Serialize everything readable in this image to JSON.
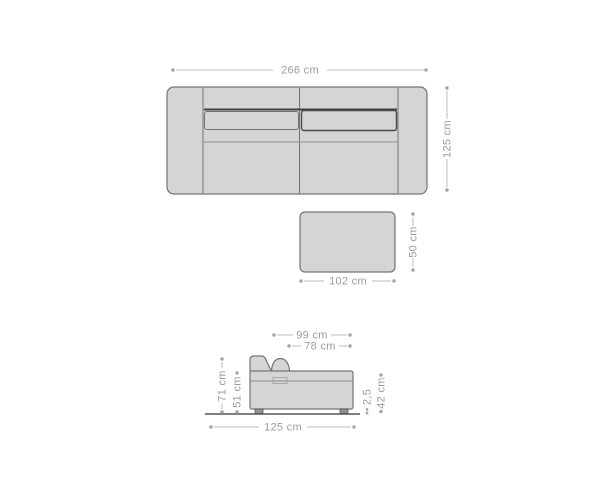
{
  "diagram_type": "sofa-dimension-diagram",
  "colors": {
    "background": "#ffffff",
    "furniture_fill": "#d4d5d6",
    "furniture_stroke": "#707478",
    "dark_accent_line": "#3e4245",
    "dimension_line": "#bcbdbe",
    "dimension_text": "#9b9c9e"
  },
  "top_view": {
    "width": "266 cm",
    "depth": "125 cm"
  },
  "ottoman": {
    "width": "102 cm",
    "depth": "50 cm"
  },
  "side_view": {
    "depth_with_cushion": "99 cm",
    "seat_depth": "78 cm",
    "back_height": "71 cm",
    "armrest_height": "51 cm",
    "total_depth": "125 cm",
    "base_thickness": "2,5",
    "seat_height": "42 cm"
  }
}
